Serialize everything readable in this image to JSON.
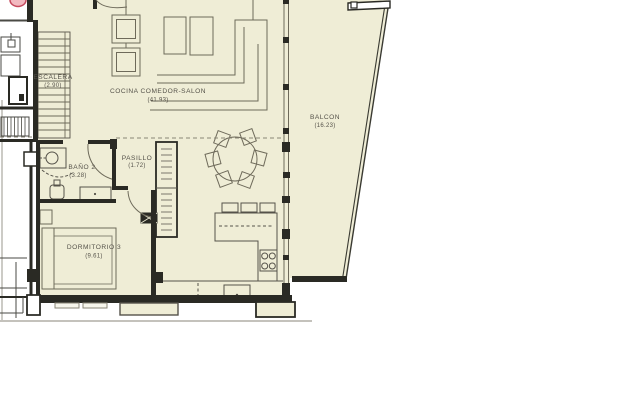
{
  "plan": {
    "title": "apartment-floor-plan",
    "rooms": [
      {
        "id": "escalera",
        "name": "ESCALERA",
        "area": "(2.90)"
      },
      {
        "id": "salon",
        "name": "COCINA COMEDOR-SALON",
        "area": "(41.93)"
      },
      {
        "id": "balcon",
        "name": "BALCON",
        "area": "(16.23)"
      },
      {
        "id": "bano",
        "name": "BAÑO 2",
        "area": "(3.28)"
      },
      {
        "id": "pasillo",
        "name": "PASILLO",
        "area": "(1.72)"
      },
      {
        "id": "dormitorio",
        "name": "DORMITORIO 3",
        "area": "(9.61)"
      }
    ],
    "colors": {
      "floor": "#efedd6",
      "wall": "#2a2a24",
      "furniture_line": "#6e6a5a",
      "label_text": "#55524a",
      "logo_pink": "#c64a5e",
      "ground_line": "#b0aea6"
    }
  }
}
